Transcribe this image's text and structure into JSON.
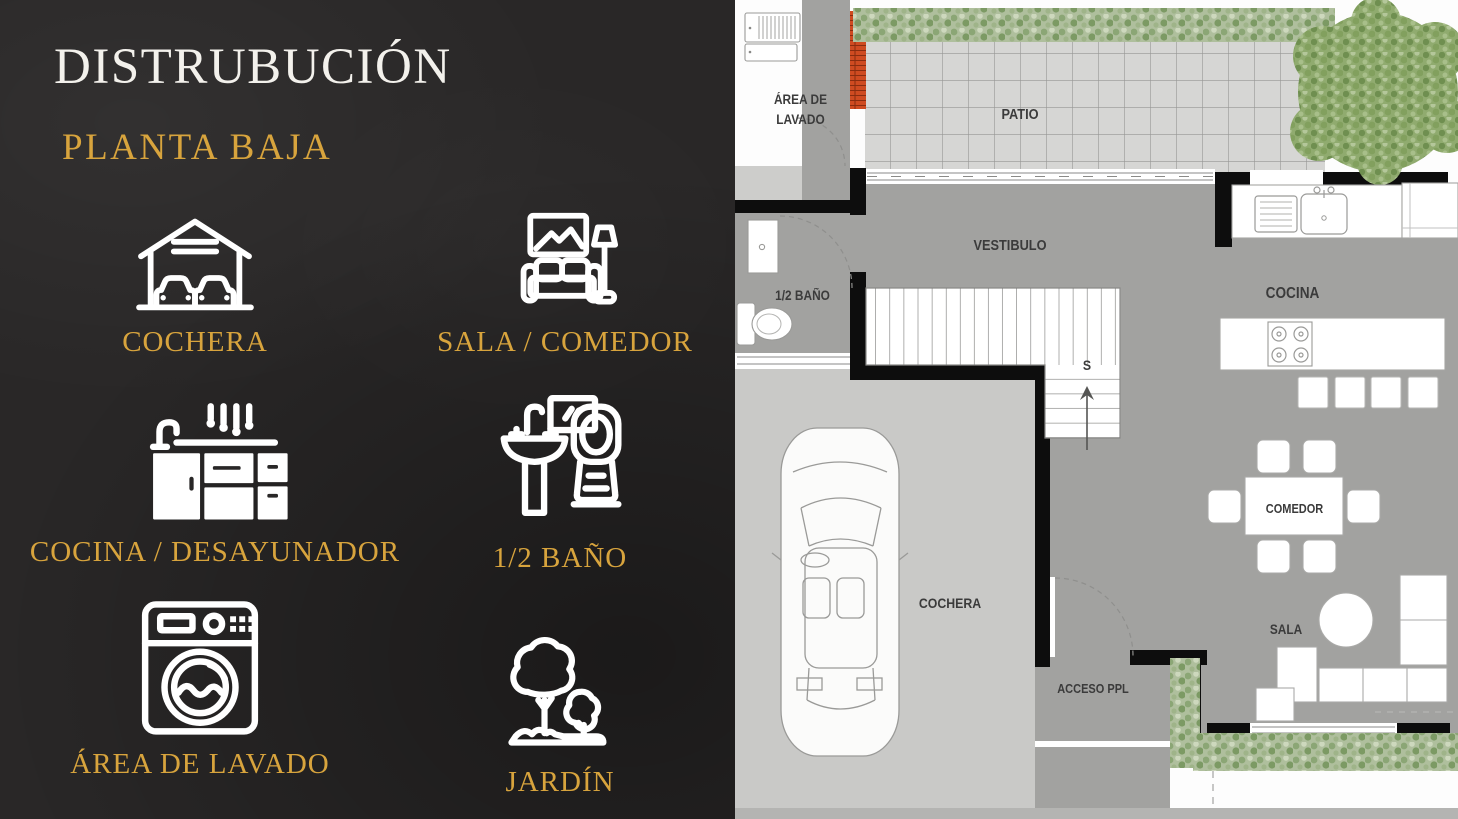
{
  "slide": {
    "title": "DISTRUBUCIÓN",
    "subtitle": "PLANTA BAJA",
    "legend": [
      {
        "label": "COCHERA",
        "icon": "garage-icon"
      },
      {
        "label": "SALA / COMEDOR",
        "icon": "sofa-lamp-icon"
      },
      {
        "label": "COCINA / DESAYUNADOR",
        "icon": "kitchen-counter-icon"
      },
      {
        "label": "1/2 BAÑO",
        "icon": "toilet-sink-icon"
      },
      {
        "label": "ÁREA DE LAVADO",
        "icon": "washing-machine-icon"
      },
      {
        "label": "JARDÍN",
        "icon": "garden-trees-icon"
      }
    ],
    "colors": {
      "background": "#292727",
      "title_text": "#f3f1ec",
      "accent_gold": "#d8a43d",
      "icon_stroke": "#ffffff"
    }
  },
  "floor_plan": {
    "labels": {
      "area_de_lavado": "ÁREA DE LAVADO",
      "patio": "PATIO",
      "vestibulo": "VESTIBULO",
      "medio_bano": "1/2 BAÑO",
      "cocina": "COCINA",
      "comedor": "COMEDOR",
      "sala": "SALA",
      "cochera": "COCHERA",
      "acceso_ppl": "ACCESO PPL",
      "stairs_direction": "S"
    },
    "colors": {
      "wall": "#0d0d0d",
      "interior_floor": "#a2a2a0",
      "garage_floor": "#c9c9c7",
      "patio_tile": "#d6d6d4",
      "hedge_green": "#aebf9d",
      "tree_green": "#90ab6f",
      "brick_orange": "#cf4b21",
      "label_text": "#3b3b3b"
    }
  }
}
